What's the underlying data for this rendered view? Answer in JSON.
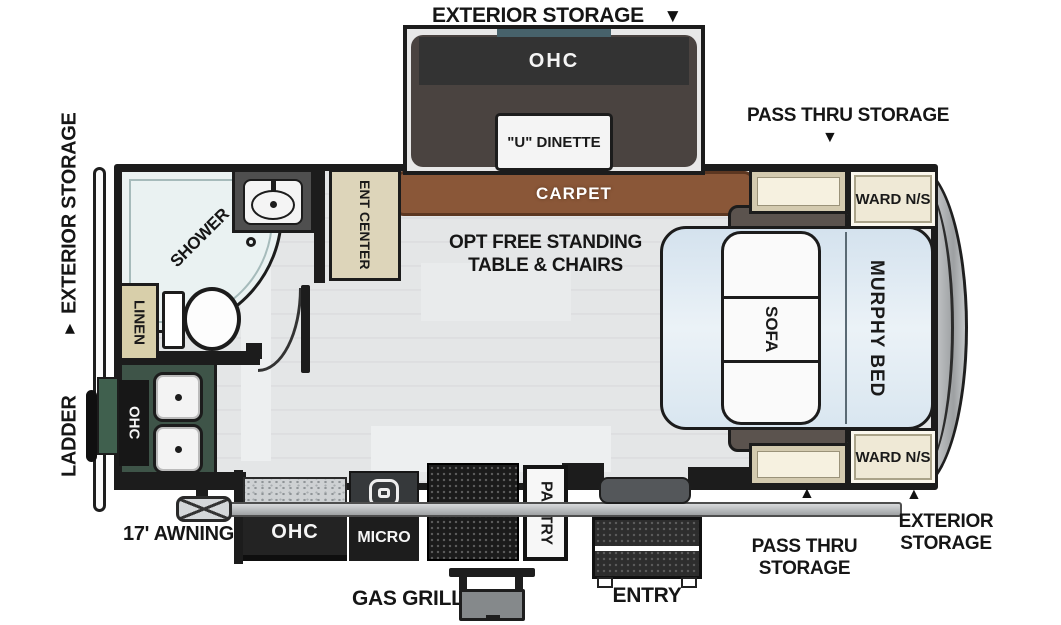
{
  "icons": {
    "arrow_down": "▼",
    "arrow_up": "▲"
  },
  "exterior": {
    "storage_top": "EXTERIOR STORAGE",
    "pass_thru_top": "PASS THRU STORAGE",
    "storage_left": "EXTERIOR STORAGE",
    "ladder": "LADDER",
    "awning": "17' AWNING",
    "gas_grill": "GAS GRILL",
    "entry": "ENTRY",
    "pass_thru_bottom_line1": "PASS THRU",
    "pass_thru_bottom_line2": "STORAGE",
    "storage_bottom_line1": "EXTERIOR",
    "storage_bottom_line2": "STORAGE"
  },
  "interior": {
    "slide_ohc": "OHC",
    "dinette": "\"U\" DINETTE",
    "carpet": "CARPET",
    "opt_line1": "OPT FREE STANDING",
    "opt_line2": "TABLE & CHAIRS",
    "shower": "SHOWER",
    "linen": "LINEN",
    "ent_center": "ENT CENTER",
    "kitchen_ohc": "OHC",
    "lower_ohc": "OHC",
    "micro": "MICRO",
    "refer": "REFER",
    "pantry": "PANTRY",
    "ward_top": "WARD N/S",
    "ward_bottom": "WARD N/S",
    "murphy_bed": "MURPHY BED",
    "sofa": "SOFA"
  },
  "colors": {
    "carpet_brown": "#8a5738",
    "counter_green": "#3e5448",
    "bed_blue": "#dfe9f2",
    "cabinet_tan": "#d3caaf",
    "seat_dark": "#4a4340"
  }
}
